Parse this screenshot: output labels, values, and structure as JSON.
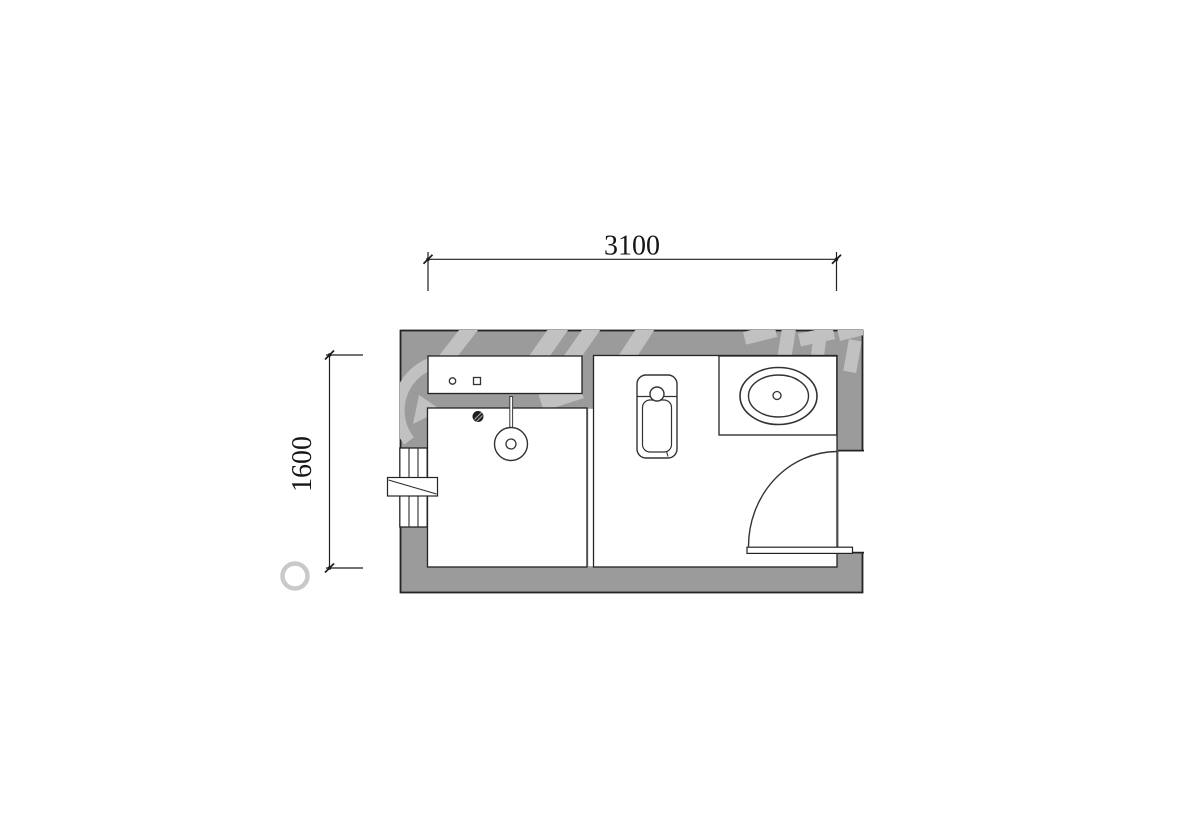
{
  "drawing": {
    "type": "bathroom-floor-plan",
    "dimensions": {
      "width_label": "3100",
      "height_label": "1600"
    },
    "colors": {
      "background": "#ffffff",
      "wall_fill": "#9b9b9b",
      "watermark": "#c2c2c2",
      "line": "#1f1f1f",
      "fixture_line": "#333333"
    },
    "fixtures": [
      "shower-niche",
      "niche-outlet-round",
      "niche-outlet-square",
      "shower-head",
      "floor-drain",
      "glass-partition",
      "window",
      "window-sash",
      "squat-toilet",
      "sink-counter",
      "sink-basin",
      "sink-drain",
      "door-leaf",
      "door-swing-arc"
    ]
  }
}
